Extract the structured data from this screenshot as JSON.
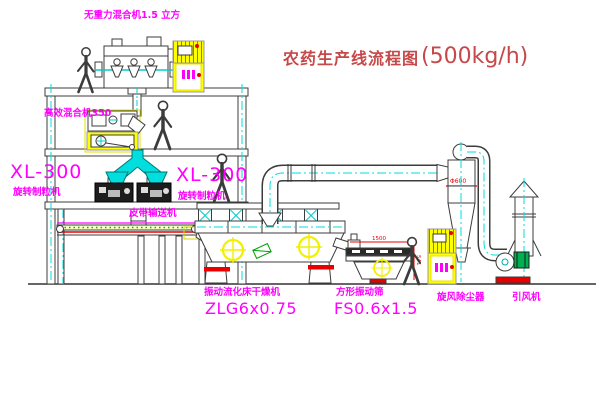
{
  "title": {
    "name": "农药生产线流程图",
    "capacity": "(500kg/h)"
  },
  "labels": {
    "gravity_mixer": "无重力混合机1.5 立方",
    "high_speed_mixer": "高效混合机350",
    "granulator_left_model": "XL-300",
    "granulator_left_name": "旋转制粒机",
    "granulator_right_model": "XL-300",
    "granulator_right_name": "旋转制粒机",
    "belt_conveyor": "皮带输送机",
    "dryer_name": "振动流化床干燥机",
    "dryer_model": "ZLG6x0.75",
    "sieve_name": "方形振动筛",
    "sieve_model": "FS0.6x1.5",
    "cyclone": "旋风除尘器",
    "fan": "引风机"
  },
  "annotations": {
    "cyclone_diameter": "Φ600",
    "sieve_length": "1500",
    "sieve_height": "541"
  },
  "colors": {
    "label_magenta": "#ff00ff",
    "title_red": "#c64848",
    "line_dark": "#3c3c3c",
    "centerline_cyan": "#00dede",
    "highlight_yellow": "#ffff00",
    "accent_red": "#e80000",
    "accent_green": "#00a850"
  }
}
